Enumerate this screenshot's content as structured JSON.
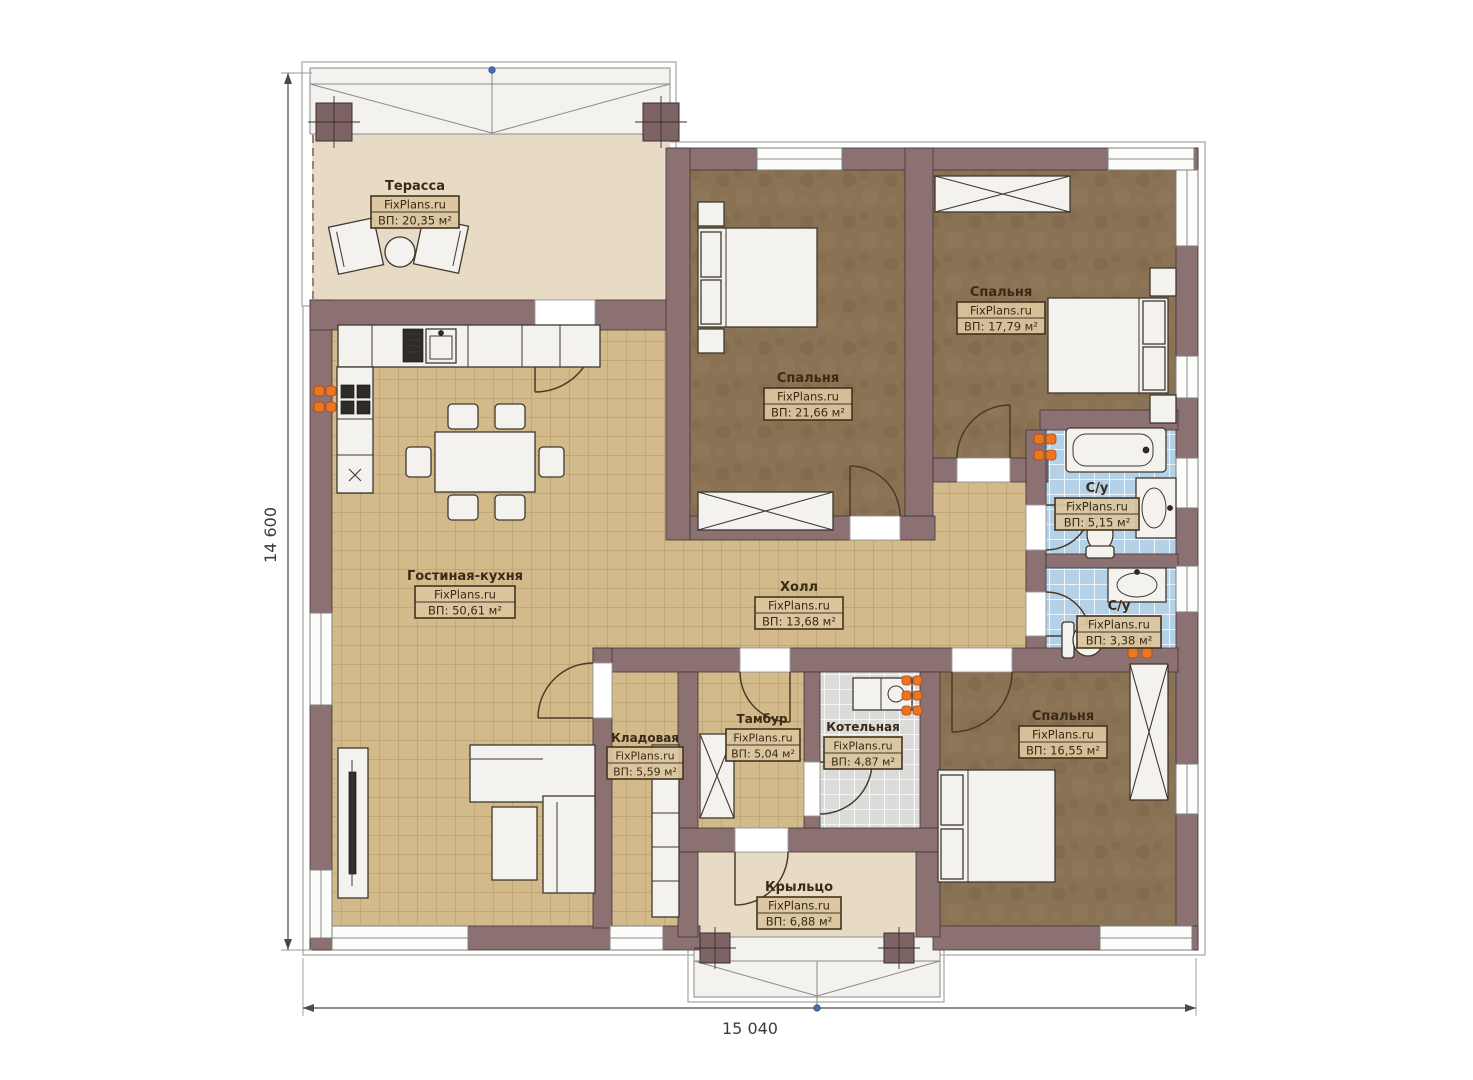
{
  "plan": {
    "brand": "FixPlans.ru",
    "rooms": [
      {
        "id": "terrace",
        "name": "Терасса",
        "area": "ВП: 20,35 м²"
      },
      {
        "id": "bedroom-1",
        "name": "Спальня",
        "area": "ВП: 21,66 м²"
      },
      {
        "id": "bedroom-2",
        "name": "Спальня",
        "area": "ВП: 17,79 м²"
      },
      {
        "id": "living-kitchen",
        "name": "Гостиная-кухня",
        "area": "ВП: 50,61 м²"
      },
      {
        "id": "hall",
        "name": "Холл",
        "area": "ВП: 13,68 м²"
      },
      {
        "id": "bathroom-1",
        "name": "С/у",
        "area": "ВП: 5,15 м²"
      },
      {
        "id": "bathroom-2",
        "name": "С/у",
        "area": "ВП: 3,38 м²"
      },
      {
        "id": "storage",
        "name": "Кладовая",
        "area": "ВП: 5,59 м²"
      },
      {
        "id": "vestibule",
        "name": "Тамбур",
        "area": "ВП: 5,04 м²"
      },
      {
        "id": "boiler-room",
        "name": "Котельная",
        "area": "ВП: 4,87 м²"
      },
      {
        "id": "bedroom-3",
        "name": "Спальня",
        "area": "ВП: 16,55 м²"
      },
      {
        "id": "porch",
        "name": "Крыльцо",
        "area": "ВП: 6,88 м²"
      }
    ],
    "dimensions": {
      "width": "15 040",
      "height": "14 600"
    },
    "colors": {
      "wall": "#8b7171",
      "floor_tile": "#d2ba8b",
      "bedroom_floor": "#8a7254",
      "bath_tile": "#b4d1e8",
      "boiler_tile": "#dbdbd9",
      "terrace_floor": "#e7dbc5",
      "label_text": "#3a2a18",
      "radiator": "#ed7420"
    }
  }
}
